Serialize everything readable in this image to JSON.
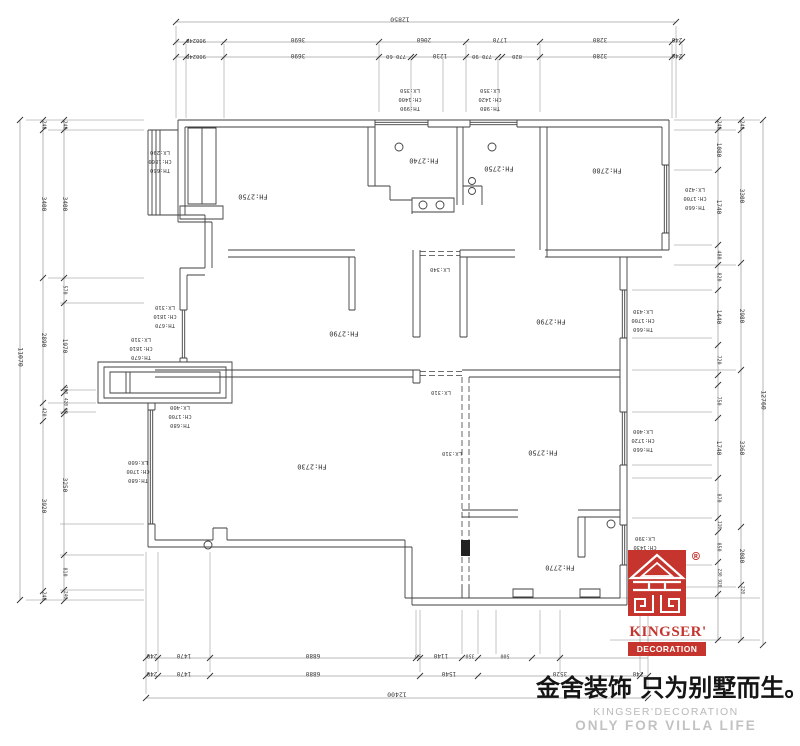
{
  "drawing": {
    "rooms": [
      "FH:2750",
      "FH:2740",
      "FH:2750",
      "FH:2780",
      "FH:2790",
      "FH:2790",
      "FH:2730",
      "FH:2750",
      "FH:2770"
    ],
    "openings": [
      "LX:340",
      "LX:310",
      "LX:310"
    ],
    "window_tags": [
      {
        "th": "TH:660",
        "ch": "CH:1800",
        "lx": "LX:290"
      },
      {
        "th": "TH:990",
        "ch": "CH:1400",
        "lx": "LX:350"
      },
      {
        "th": "TH:980",
        "ch": "CH:1420",
        "lx": "LX:350"
      },
      {
        "th": "TH:660",
        "ch": "CH:1700",
        "lx": "LX:420"
      },
      {
        "th": "TH:670",
        "ch": "CH:1810",
        "lx": "LX:310"
      },
      {
        "th": "TH:670",
        "ch": "CH:1810",
        "lx": "LX:310"
      },
      {
        "th": "TH:660",
        "ch": "CH:1700",
        "lx": "LX:430"
      },
      {
        "th": "TH:660",
        "ch": "CH:1720",
        "lx": "LX:400"
      },
      {
        "th": "TH:680",
        "ch": "CH:1700",
        "lx": "LX:400"
      },
      {
        "th": "TH:680",
        "ch": "CH:1700",
        "lx": "LX:600"
      },
      {
        "th": "TH:950",
        "ch": "CH:1430",
        "lx": "LX:390"
      }
    ],
    "dims": {
      "top_total": "12850",
      "top_row1": [
        "900240",
        "3690",
        "2060",
        "1770",
        "3280",
        "240"
      ],
      "top_row2": [
        "900240",
        "3690",
        "770 60",
        "1230",
        "770 90",
        "820",
        "3280",
        "240"
      ],
      "bottom_row1": [
        "240",
        "1470",
        "6880",
        "50",
        "1140",
        "350",
        "500"
      ],
      "bottom_row2": [
        "240",
        "1470",
        "6880",
        "1540",
        "3520",
        "240"
      ],
      "bottom_total": "12400",
      "left_total": "11070",
      "left_mid": [
        "240",
        "3400",
        "2890",
        "420",
        "3920",
        "240"
      ],
      "left_inner": [
        "240",
        "3400",
        "570",
        "1970",
        "100",
        "420",
        "60",
        "3250",
        "810",
        "240"
      ],
      "right_total": "12760",
      "right_mid": [
        "240",
        "3300",
        "2980",
        "3360",
        "2080",
        "220"
      ],
      "right_inner": [
        "240",
        "1080",
        "1740",
        "480",
        "820",
        "1440",
        "720",
        "750",
        "1740",
        "870",
        "110",
        "850",
        "230 920"
      ]
    }
  },
  "logo": {
    "registered": "®",
    "name": "KINGSER'",
    "sub": "DECORATION",
    "color": "#c5352e"
  },
  "watermark": {
    "chinese": "金舍装饰 只为别墅而生。",
    "brand": "KINGSER'DECORATION",
    "slogan": "ONLY FOR VILLA LIFE"
  }
}
